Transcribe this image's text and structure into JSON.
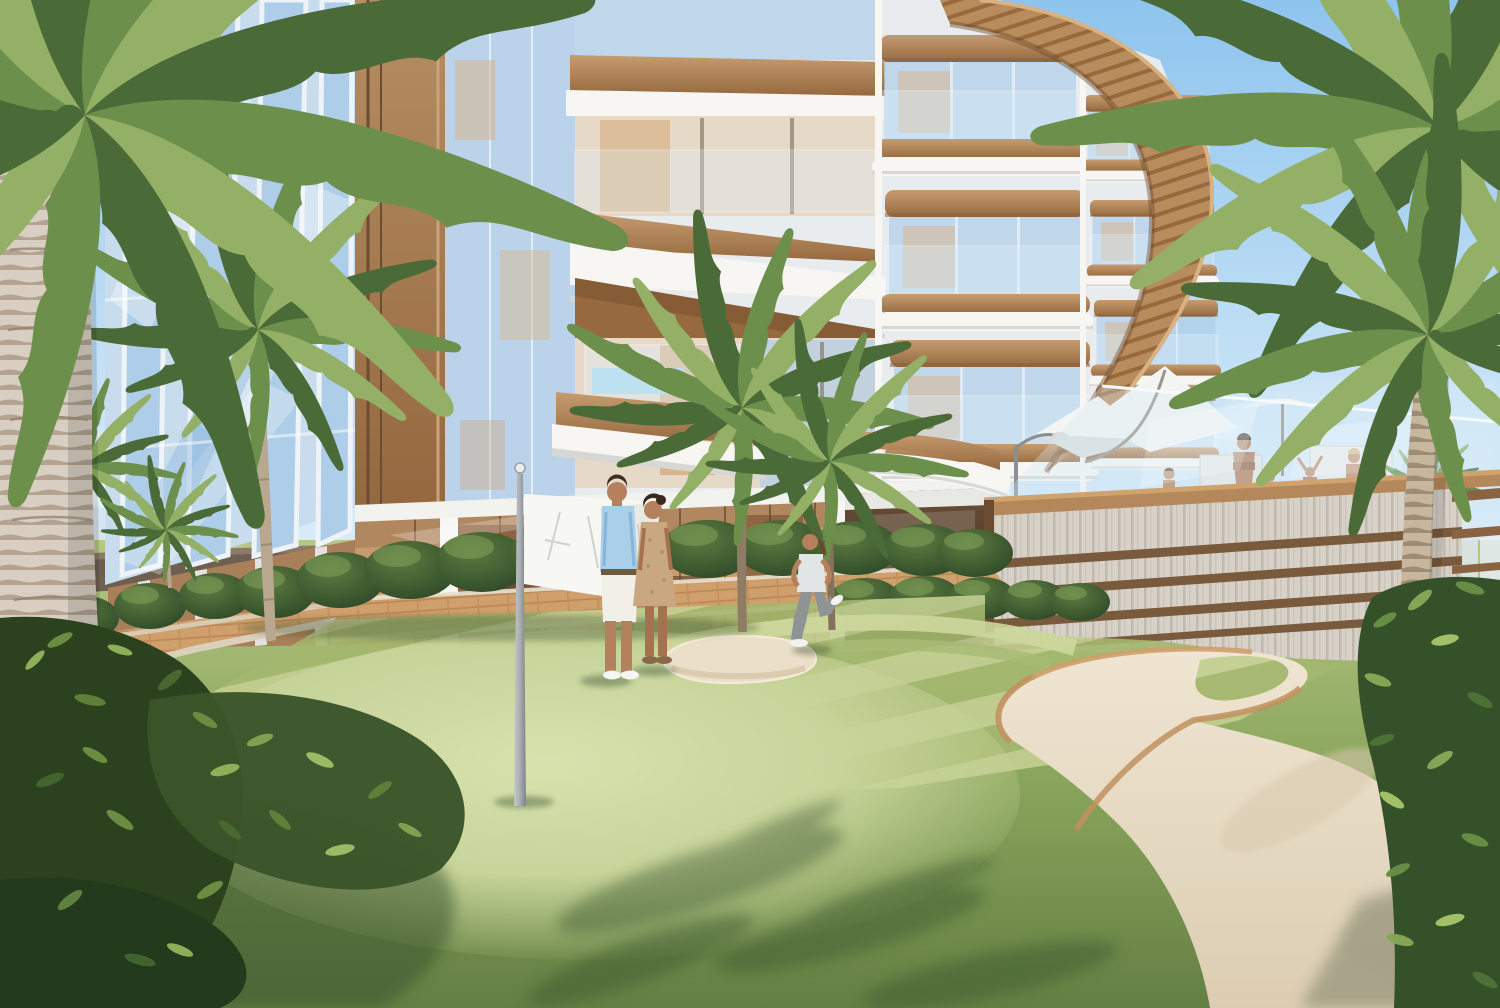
{
  "scene": {
    "description": "3D architectural rendering: luxury low-rise residence with wood-trimmed curved balconies and a rounded timber-slat canopy, palm trees, a mini-golf putting green with a white flag, striped mown lawn, sand bunkers with timber edging, brick walkways with hedges, a couple standing by the flag, a woman jogging, a rooftop pool terrace with shade sails and bathers behind a slatted privacy wall, city skyline at the horizon, clear blue sky.",
    "objects": [
      "sky",
      "clouds",
      "city-skyline",
      "residential-building",
      "glass-curtain-wall",
      "wood-corner-pier",
      "balconies",
      "timber-canopy",
      "ground-floor-storefront",
      "entrance-passage",
      "privacy-wall",
      "pool-terrace",
      "shade-sails",
      "terrace-people",
      "putting-green",
      "golf-flag",
      "sand-bunkers",
      "brick-path",
      "hedges",
      "palm-trees",
      "couple",
      "jogger",
      "foreground-bushes"
    ]
  },
  "palette": {
    "sky_top": "#8ec4ee",
    "sky_mid": "#c6e2f6",
    "sky_horizon": "#eaf4fb",
    "skyline": "#dce8f2",
    "facade_white": "#f7f6f3",
    "facade_shadow": "#e2e3e0",
    "wood": "#b68a5f",
    "wood_dark": "#8a6240",
    "wood_light": "#cba376",
    "glass_blue": "#aecde8",
    "interior_warm": "#d9b088",
    "interior_dark": "#8a5f3e",
    "entrance_dark": "#44311f",
    "water_blue": "#a8d8ee",
    "wall_plank": "#d7d1c8",
    "wall_rail": "#7a5a3c",
    "coping": "#b4885a",
    "lawn_light": "#b7c686",
    "lawn_stripe_a": "#c3cf92",
    "lawn_stripe_b": "#a4b76e",
    "lawn_rough": "#7d9a55",
    "putting_green": "#d2dda6",
    "shadow_green": "#3a542c",
    "sand": "#ecdfc9",
    "sand_shadow": "#d6c4a8",
    "sand_edge": "#c1915e",
    "path_brick": "#cf9f6c",
    "curb": "#e2dac9",
    "hedge_dark": "#2f4a28",
    "hedge_mid": "#4d7036",
    "hedge_light": "#86a45a",
    "frond_dark": "#4a6b38",
    "frond_mid": "#6d8f4c",
    "frond_light": "#93b066",
    "trunk_light": "#d8cfc2",
    "trunk_dark": "#b3a390",
    "trunk_right": "#c7b79f",
    "fence_brown": "#6e6050",
    "flag_white": "#f7f7f4",
    "pole_grey": "#a8adb2",
    "skin": "#b5805d",
    "hair_dark": "#3f2d20",
    "shirt_blue": "#a9cfe9",
    "shorts_white": "#f1efe7",
    "dress_beige": "#c9a780",
    "jogger_top": "#e2e5e5",
    "jogger_leggings": "#8e9394",
    "sail_white": "#f4f5f2"
  }
}
